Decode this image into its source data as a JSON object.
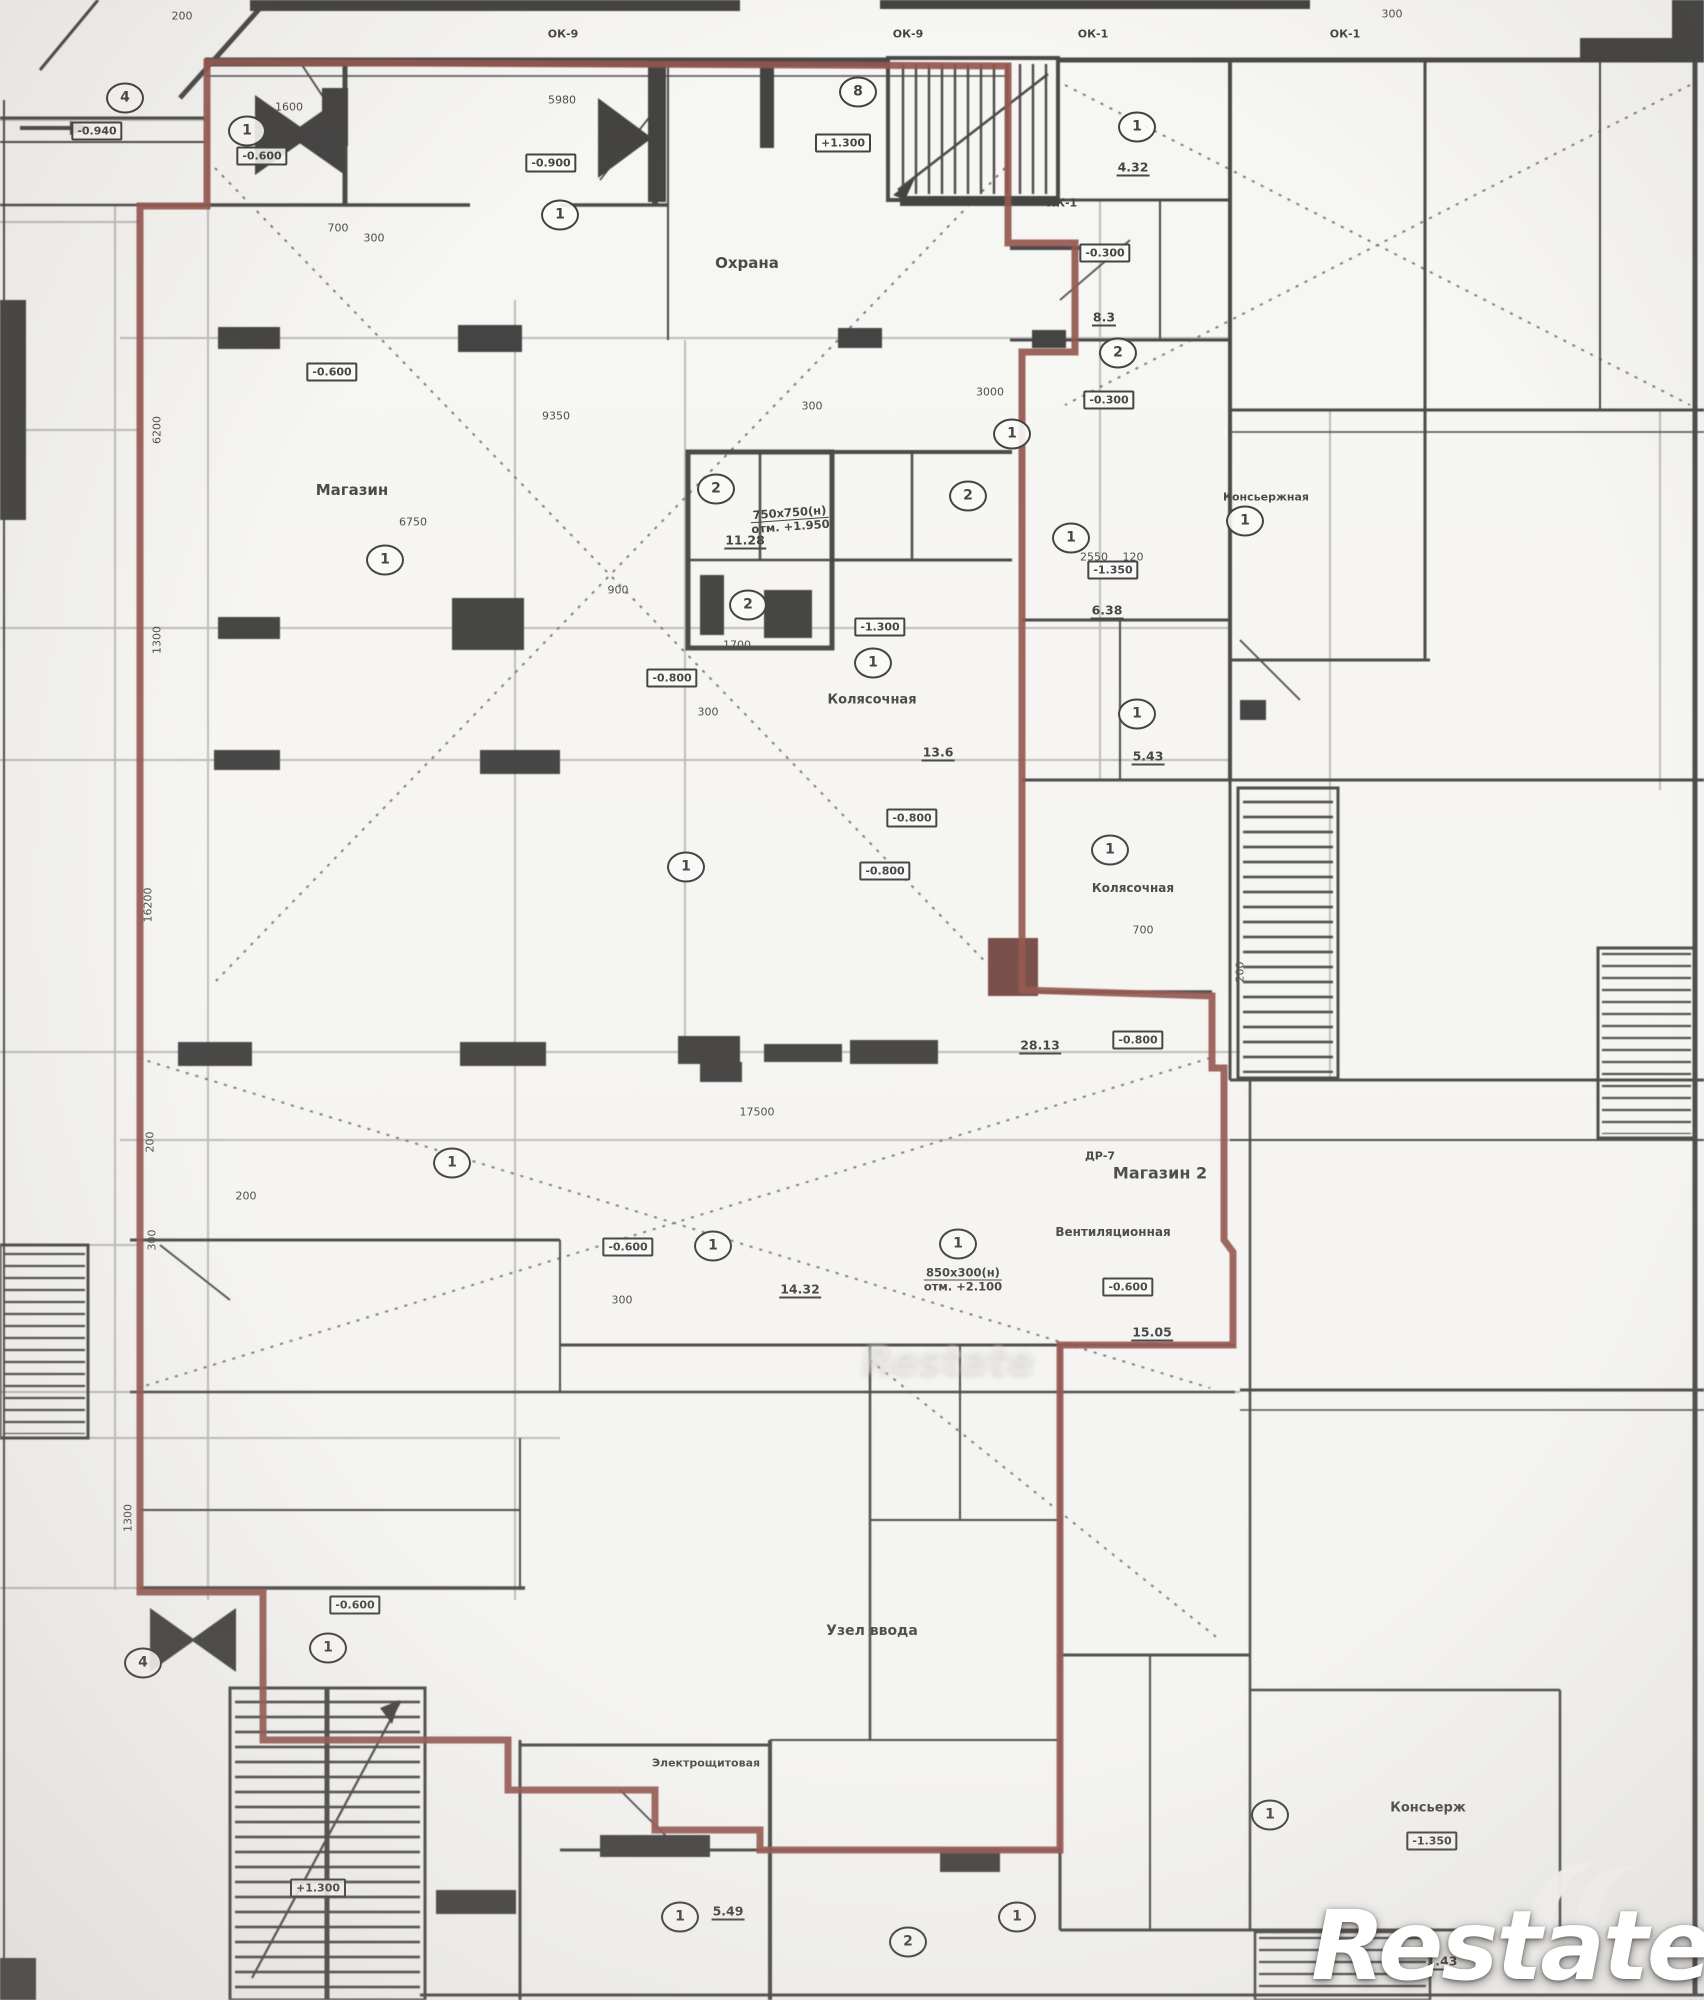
{
  "document": {
    "kind": "floor-plan-scan"
  },
  "colors": {
    "unit_boundary": "#7b2c24",
    "walls": "#1c1c1c",
    "paper": "#fafaf8"
  },
  "watermark": {
    "r": "R",
    "estate": "estate",
    "ghost": "Restate"
  },
  "plan": {
    "rooms": [
      {
        "t": "Охрана",
        "x": 747,
        "y": 263,
        "fs": 15
      },
      {
        "t": "Магазин",
        "x": 352,
        "y": 490,
        "fs": 15
      },
      {
        "t": "Магазин 2",
        "x": 1160,
        "y": 1173,
        "fs": 16
      },
      {
        "t": "Колясочная",
        "x": 872,
        "y": 700,
        "fs": 13
      },
      {
        "t": "Колясочная",
        "x": 1133,
        "y": 888,
        "fs": 12
      },
      {
        "t": "Консьержная",
        "x": 1266,
        "y": 497,
        "fs": 11
      },
      {
        "t": "Консьерж",
        "x": 1428,
        "y": 1808,
        "fs": 13
      },
      {
        "t": "Узел ввода",
        "x": 872,
        "y": 1631,
        "fs": 14
      },
      {
        "t": "Электрощитовая",
        "x": 706,
        "y": 1763,
        "fs": 11
      },
      {
        "t": "Вентиляционная",
        "x": 1113,
        "y": 1232,
        "fs": 12
      }
    ],
    "elevations": [
      {
        "t": "-0.940",
        "x": 97,
        "y": 131
      },
      {
        "t": "-0.600",
        "x": 262,
        "y": 156
      },
      {
        "t": "-0.900",
        "x": 551,
        "y": 163
      },
      {
        "t": "+1.300",
        "x": 843,
        "y": 143
      },
      {
        "t": "-0.300",
        "x": 1105,
        "y": 253
      },
      {
        "t": "-0.300",
        "x": 1109,
        "y": 400
      },
      {
        "t": "-1.350",
        "x": 1113,
        "y": 570
      },
      {
        "t": "-0.600",
        "x": 332,
        "y": 372
      },
      {
        "t": "-0.800",
        "x": 672,
        "y": 678
      },
      {
        "t": "-1.300",
        "x": 880,
        "y": 627
      },
      {
        "t": "-0.800",
        "x": 912,
        "y": 818
      },
      {
        "t": "-0.800",
        "x": 885,
        "y": 871
      },
      {
        "t": "-0.800",
        "x": 1138,
        "y": 1040
      },
      {
        "t": "-0.600",
        "x": 628,
        "y": 1247
      },
      {
        "t": "-0.600",
        "x": 1128,
        "y": 1287
      },
      {
        "t": "-0.600",
        "x": 355,
        "y": 1605
      },
      {
        "t": "+1.300",
        "x": 318,
        "y": 1888
      },
      {
        "t": "-1.350",
        "x": 1432,
        "y": 1841
      }
    ],
    "grid_bubbles": [
      {
        "t": "4",
        "x": 125,
        "y": 98
      },
      {
        "t": "1",
        "x": 247,
        "y": 131
      },
      {
        "t": "8",
        "x": 858,
        "y": 92
      },
      {
        "t": "1",
        "x": 1137,
        "y": 127
      },
      {
        "t": "1",
        "x": 560,
        "y": 215
      },
      {
        "t": "2",
        "x": 1118,
        "y": 353
      },
      {
        "t": "1",
        "x": 1012,
        "y": 434
      },
      {
        "t": "1",
        "x": 385,
        "y": 560
      },
      {
        "t": "2",
        "x": 716,
        "y": 489
      },
      {
        "t": "2",
        "x": 748,
        "y": 605
      },
      {
        "t": "2",
        "x": 968,
        "y": 496
      },
      {
        "t": "1",
        "x": 1071,
        "y": 538
      },
      {
        "t": "1",
        "x": 873,
        "y": 663
      },
      {
        "t": "1",
        "x": 1137,
        "y": 714
      },
      {
        "t": "1",
        "x": 1110,
        "y": 850
      },
      {
        "t": "1",
        "x": 1245,
        "y": 521
      },
      {
        "t": "1",
        "x": 686,
        "y": 867
      },
      {
        "t": "1",
        "x": 452,
        "y": 1163
      },
      {
        "t": "1",
        "x": 713,
        "y": 1246
      },
      {
        "t": "1",
        "x": 958,
        "y": 1244
      },
      {
        "t": "4",
        "x": 143,
        "y": 1663
      },
      {
        "t": "1",
        "x": 328,
        "y": 1648
      },
      {
        "t": "1",
        "x": 680,
        "y": 1917
      },
      {
        "t": "2",
        "x": 908,
        "y": 1942
      },
      {
        "t": "1",
        "x": 1017,
        "y": 1917
      },
      {
        "t": "1",
        "x": 1270,
        "y": 1815
      }
    ],
    "window_tags": [
      {
        "t": "ОК-9",
        "x": 563,
        "y": 34
      },
      {
        "t": "ОК-9",
        "x": 908,
        "y": 34
      },
      {
        "t": "ОК-1",
        "x": 1093,
        "y": 34
      },
      {
        "t": "ОК-1",
        "x": 1345,
        "y": 34
      },
      {
        "t": "ЛК-1",
        "x": 1062,
        "y": 203
      },
      {
        "t": "ДР-7",
        "x": 1100,
        "y": 1156
      }
    ],
    "notes": [
      {
        "l1": "750х750(н)",
        "l2": "отм. +1.950",
        "x": 790,
        "y": 520,
        "r": -4
      },
      {
        "l1": "850х300(н)",
        "l2": "отм. +2.100",
        "x": 963,
        "y": 1280,
        "r": 0
      }
    ],
    "dimensions": [
      {
        "t": "200",
        "x": 182,
        "y": 16
      },
      {
        "t": "300",
        "x": 1392,
        "y": 14
      },
      {
        "t": "5980",
        "x": 562,
        "y": 100
      },
      {
        "t": "1600",
        "x": 289,
        "y": 107
      },
      {
        "t": "700",
        "x": 338,
        "y": 228
      },
      {
        "t": "300",
        "x": 374,
        "y": 238
      },
      {
        "t": "6200",
        "x": 157,
        "y": 430,
        "r": -90
      },
      {
        "t": "1300",
        "x": 157,
        "y": 640,
        "r": -90
      },
      {
        "t": "16200",
        "x": 148,
        "y": 905,
        "r": -90
      },
      {
        "t": "200",
        "x": 150,
        "y": 1142,
        "r": -90
      },
      {
        "t": "300",
        "x": 152,
        "y": 1240,
        "r": -90
      },
      {
        "t": "1300",
        "x": 128,
        "y": 1518,
        "r": -90
      },
      {
        "t": "6750",
        "x": 413,
        "y": 522
      },
      {
        "t": "9350",
        "x": 556,
        "y": 416
      },
      {
        "t": "300",
        "x": 812,
        "y": 406
      },
      {
        "t": "900",
        "x": 618,
        "y": 590
      },
      {
        "t": "1700",
        "x": 737,
        "y": 645
      },
      {
        "t": "300",
        "x": 708,
        "y": 712
      },
      {
        "t": "700",
        "x": 1143,
        "y": 930
      },
      {
        "t": "200",
        "x": 1240,
        "y": 972,
        "r": -90
      },
      {
        "t": "17500",
        "x": 757,
        "y": 1112
      },
      {
        "t": "2550",
        "x": 1094,
        "y": 557
      },
      {
        "t": "120",
        "x": 1133,
        "y": 557
      },
      {
        "t": "3000",
        "x": 990,
        "y": 392
      },
      {
        "t": "200",
        "x": 246,
        "y": 1196
      },
      {
        "t": "300",
        "x": 622,
        "y": 1300
      }
    ],
    "areas": [
      {
        "t": "28.13",
        "x": 1040,
        "y": 1046
      },
      {
        "t": "15.05",
        "x": 1152,
        "y": 1333
      },
      {
        "t": "14.32",
        "x": 800,
        "y": 1290
      },
      {
        "t": "11.28",
        "x": 745,
        "y": 541
      },
      {
        "t": "13.6",
        "x": 938,
        "y": 753
      },
      {
        "t": "5.43",
        "x": 1148,
        "y": 757
      },
      {
        "t": "6.38",
        "x": 1107,
        "y": 611
      },
      {
        "t": "8.3",
        "x": 1104,
        "y": 318
      },
      {
        "t": "4.32",
        "x": 1133,
        "y": 168
      },
      {
        "t": "5.49",
        "x": 728,
        "y": 1912
      },
      {
        "t": "1.43",
        "x": 1442,
        "y": 1962
      }
    ]
  }
}
